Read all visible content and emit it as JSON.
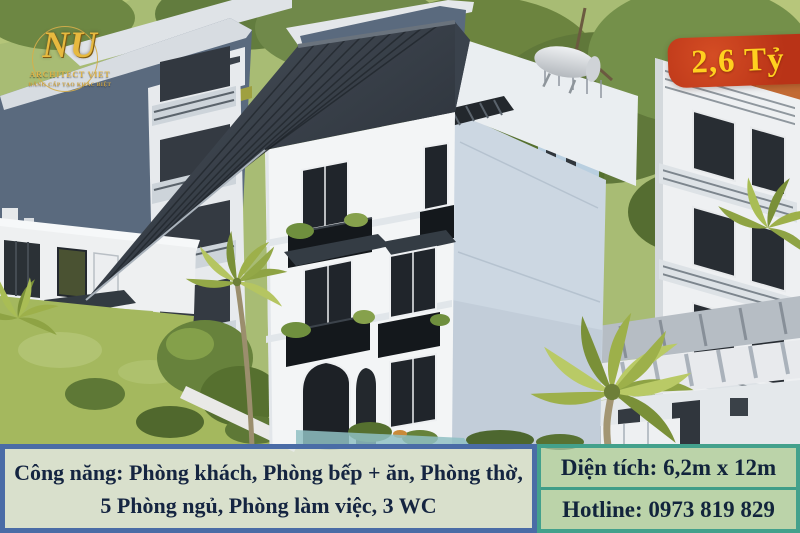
{
  "logo": {
    "monogram": "NU",
    "brand": "ARCHITECT VIET",
    "tagline": "ĐẲNG CẤP TẠO KHÁC BIỆT"
  },
  "price_badge": {
    "label": "2,6 Tỷ"
  },
  "info_banner": {
    "features_line1": "Công năng: Phòng khách, Phòng bếp + ăn, Phòng thờ,",
    "features_line2": "5 Phòng ngủ, Phòng làm việc, 3 WC",
    "area": "Diện tích: 6,2m x 12m",
    "hotline": "Hotline: 0973 819 829"
  },
  "colors": {
    "badge_bg": "#bd3518",
    "badge_text": "#ffd01f",
    "logo_gold": "#e0b54a",
    "features_border": "#4a6ca6",
    "contact_border": "#43a18c",
    "banner_text": "#152541",
    "roof": "#2e353d",
    "house_wall": "#f3f5f6",
    "neighbor_blue_gray": "#5a6a7e",
    "lawn": "#a4b85e"
  }
}
